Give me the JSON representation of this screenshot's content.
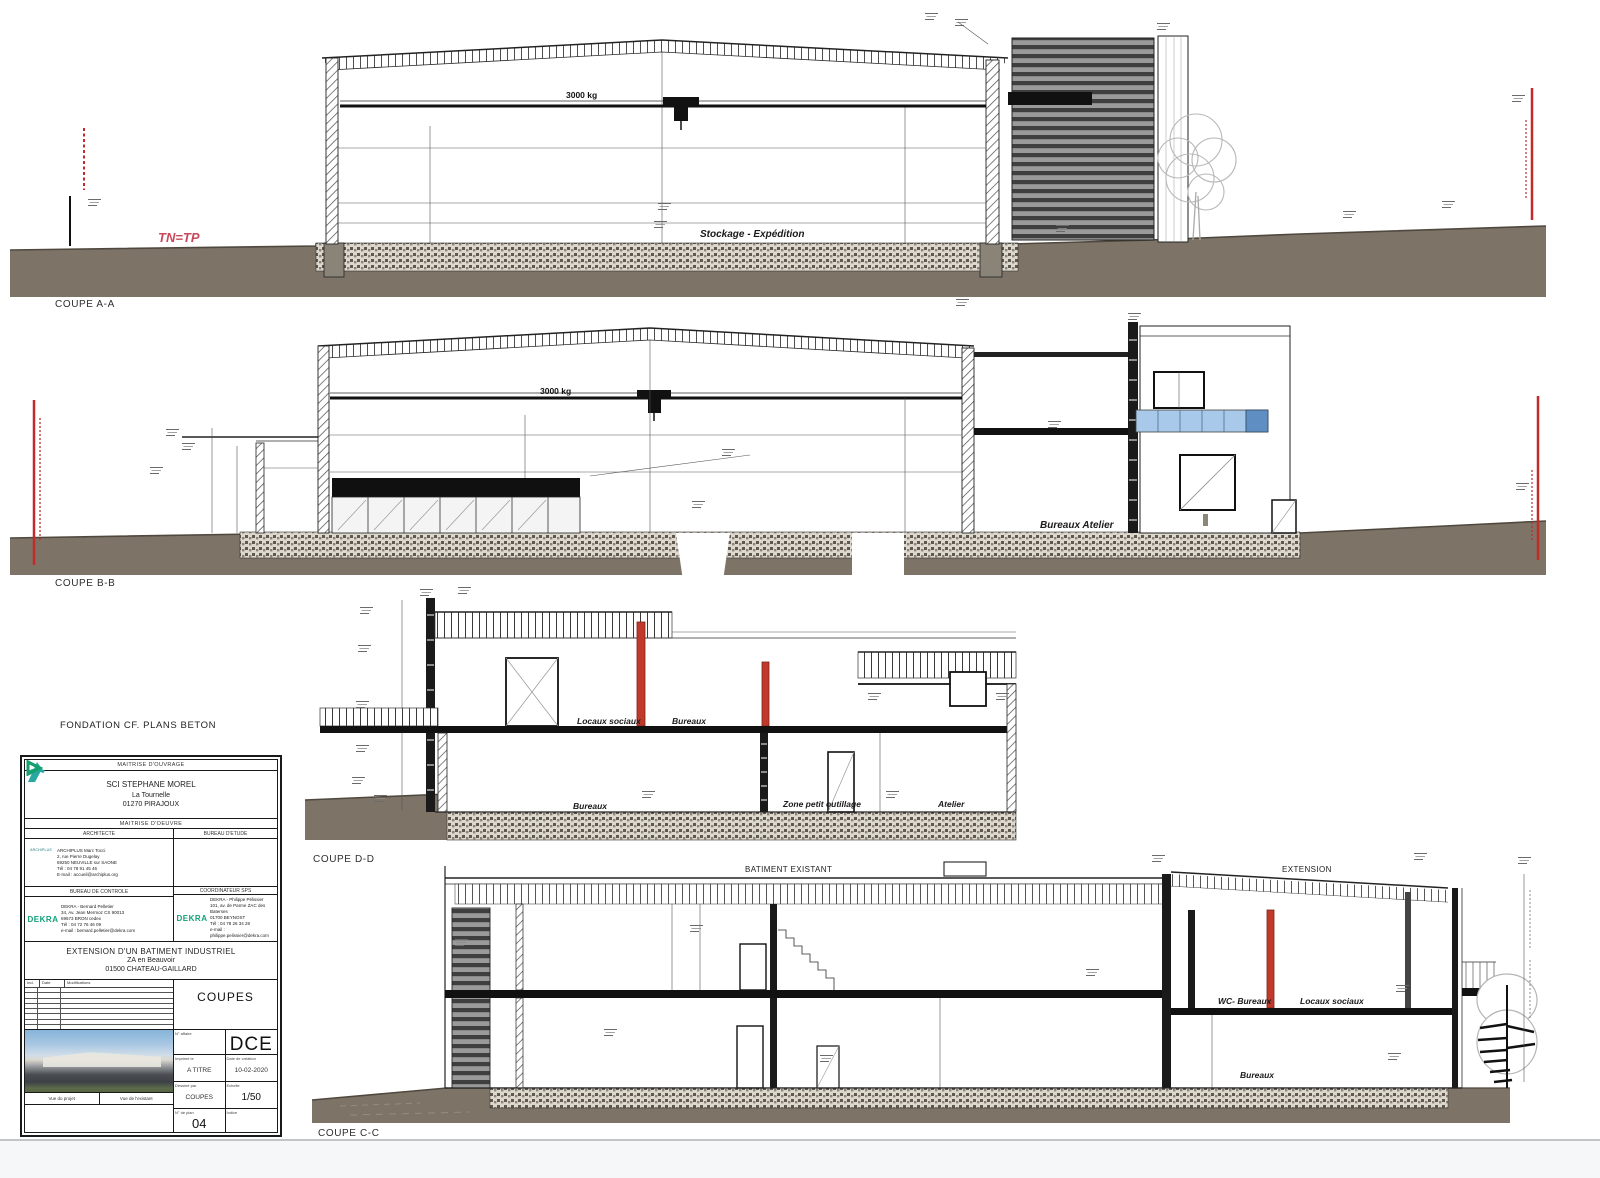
{
  "sheet": {
    "fondation_note": "FONDATION CF. PLANS BETON"
  },
  "sections": {
    "a": {
      "label": "COUPE A-A",
      "crane": "3000 kg",
      "room": "Stockage - Expédition",
      "ground_note": "TN=TP"
    },
    "b": {
      "label": "COUPE B-B",
      "crane": "3000 kg",
      "room": "Bureaux Atelier"
    },
    "d": {
      "label": "COUPE D-D",
      "room_upper_left": "Locaux sociaux",
      "room_upper_right": "Bureaux",
      "room_lower_left": "Bureaux",
      "room_lower_mid": "Zone petit outillage",
      "room_lower_right": "Atelier"
    },
    "c": {
      "label": "COUPE C-C",
      "zone_left": "BATIMENT EXISTANT",
      "zone_right": "EXTENSION",
      "room_wc": "WC- Bureaux",
      "room_locaux": "Locaux sociaux",
      "room_bureaux": "Bureaux"
    }
  },
  "titleblock": {
    "owner_header": "MAITRISE D'OUVRAGE",
    "owner_name": "SCI STEPHANE MOREL",
    "owner_line2": "La Tournelle",
    "owner_line3": "01270 PIRAJOUX",
    "moe_header": "MAITRISE D'OEUVRE",
    "architect_header": "ARCHITECTE",
    "architect_logo": "ARCHIPLUS",
    "architect_lines": [
      "ARCHIPLUS Marc Tocci",
      "2, rue Pierre Dugelay",
      "69250 NEUVILLE sur SAONE",
      "Tél : 04 78 91 45 45",
      "E-mail : accueil@archiplus.org"
    ],
    "bet_header": "BUREAU D'ETUDE",
    "control_header": "BUREAU DE CONTROLE",
    "control_logo": "DEKRA",
    "control_lines": [
      "DEKRA - Bernard Pelletier",
      "34, Av. Jean Mermoz CS 90013",
      "69673 BRON cedex",
      "Tél : 04 72 76 46 09",
      "e-mail : bernard.pelletier@dekra.com"
    ],
    "sps_header": "COORDINATEUR SPS",
    "sps_logo": "DEKRA",
    "sps_lines": [
      "DEKRA - Philippe Pélissier",
      "101, av. de Parme ZAC des Baterses",
      "01700 BEYNOST",
      "Tél : 04 78 26 34 28",
      "e-mail : philippe.pelissier@dekra.com"
    ],
    "project_title": "EXTENSION D'UN BATIMENT INDUSTRIEL",
    "project_line2": "ZA en Beauvoir",
    "project_line3": "01500 CHATEAU-GAILLARD",
    "revision_headers": [
      "Ind.",
      "Date",
      "Modifications"
    ],
    "drawing_title": "COUPES",
    "photo_caption_left": "Vue du projet",
    "photo_caption_right": "Vue de l'existant",
    "meta": {
      "affaire_label": "N° affaire",
      "affaire_value": "",
      "phase_value": "DCE",
      "print_label": "Imprimé le",
      "print_value": "A TITRE",
      "date_label": "Date de création",
      "date_value": "10-02-2020",
      "drawn_label": "Dessiné par",
      "drawn_value": "COUPES",
      "scale_label": "Echelle",
      "scale_value": "1/50",
      "plan_label": "N° de plan",
      "plan_value": "04",
      "indice_label": "Indice",
      "indice_value": ""
    }
  }
}
